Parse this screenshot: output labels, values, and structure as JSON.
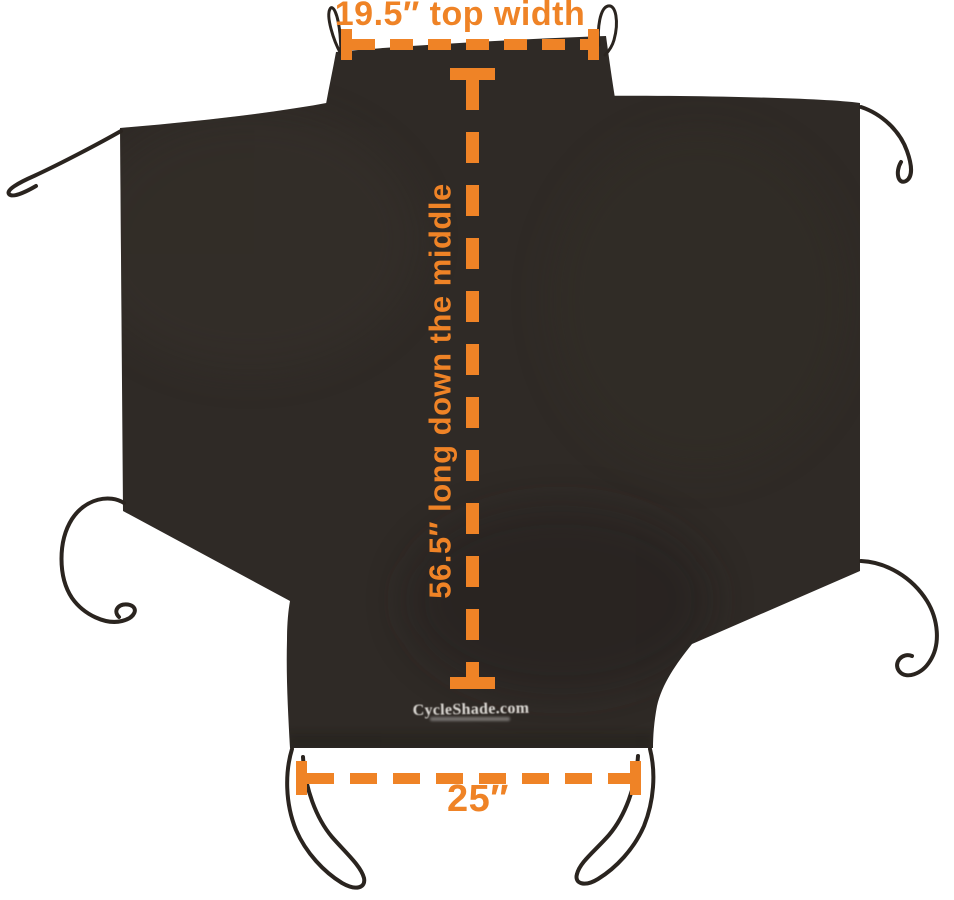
{
  "figure": {
    "description": "Black CycleShade cover laid flat with orange dimension callouts",
    "background_color": "#FFFFFF",
    "fabric_color": "#2F2A26",
    "accent_color": "#EF8326",
    "cord_color": "#2A241F",
    "logo": {
      "text": "CycleShade.com",
      "color": "#EBE8E3"
    },
    "dimensions": {
      "top_width": {
        "label": "19.5″ top width",
        "value_inches": 19.5,
        "orientation": "horizontal"
      },
      "middle_length": {
        "label": "56.5″ long down the middle",
        "value_inches": 56.5,
        "orientation": "vertical"
      },
      "bottom_width": {
        "label": "25″",
        "value_inches": 25,
        "orientation": "horizontal"
      }
    }
  }
}
